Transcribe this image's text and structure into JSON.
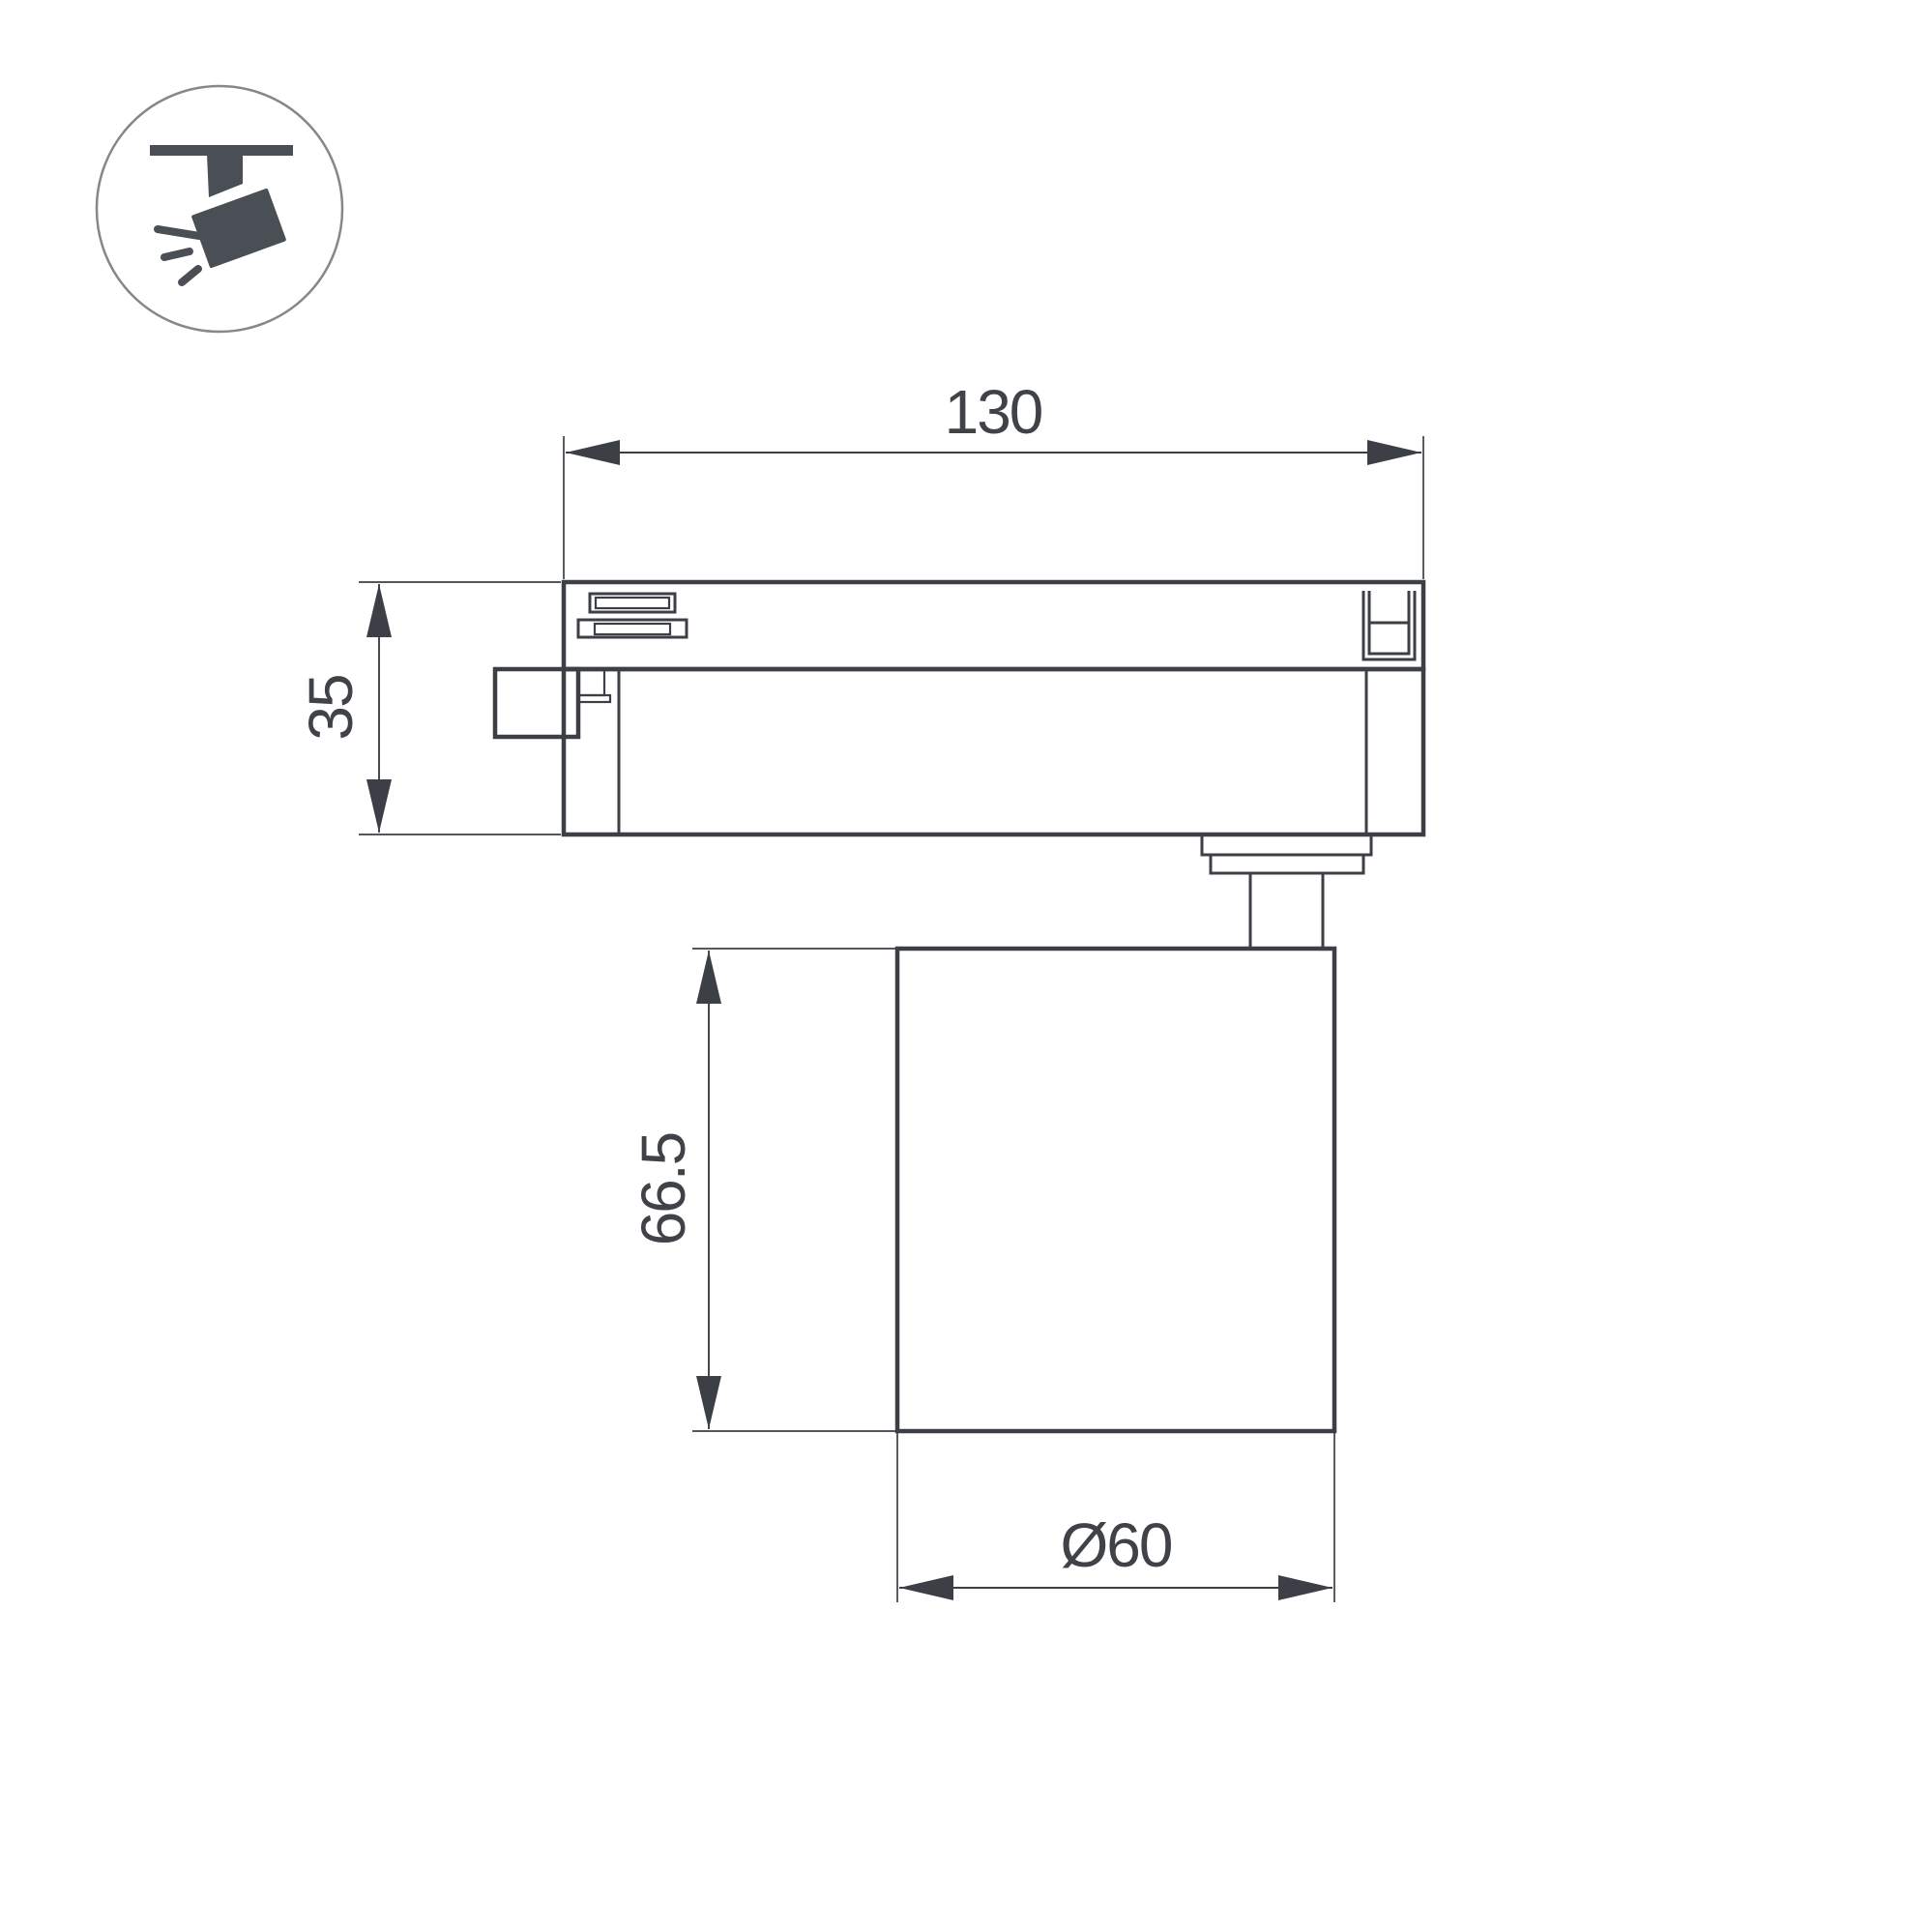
{
  "colors": {
    "background": "#ffffff",
    "line": "#3c4046",
    "text": "#3f4348",
    "icon_fill": "#4a4f55",
    "icon_circle_stroke": "#84878c"
  },
  "icons": [
    {
      "name": "track-spotlight-icon",
      "meaning": "spotlight mounted on ceiling track, tilted, emitting light rays"
    }
  ],
  "dimensions": {
    "track_width": "130",
    "track_height": "35",
    "body_height": "66.5",
    "body_diameter": "Ø60"
  }
}
